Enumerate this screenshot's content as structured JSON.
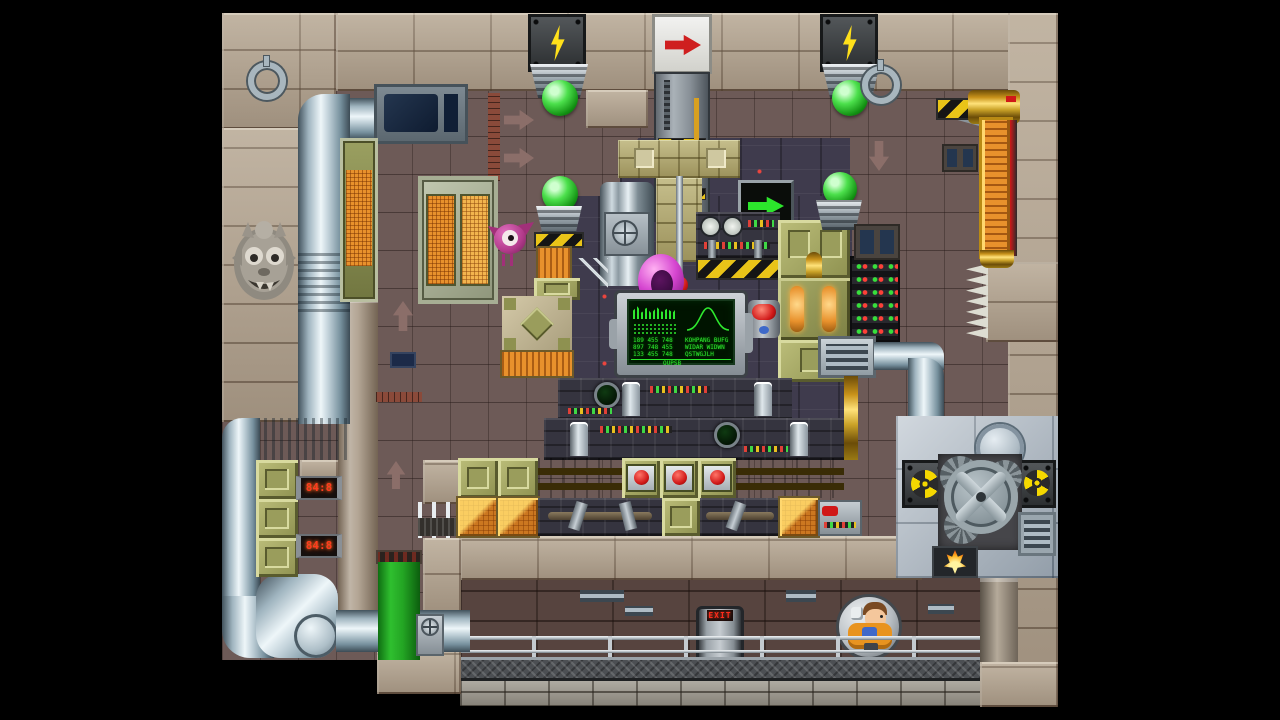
{
  "scene": {
    "name": "industrial factory puzzle level",
    "viewport": "1280x720",
    "letterbox": "black side bars",
    "actors": {
      "player": "engineer inside hamster wheel",
      "enemy": "pink one-eyed flyer"
    },
    "collectibles": {
      "green_gems": 4,
      "pink_ring": 1
    }
  },
  "palette": {
    "interior_wall": "#6d5a57",
    "stone": "#b2a390",
    "chrome_pipe": "#c9d6dd",
    "gold_conveyor": "#e8b21f",
    "olive_crate": "#9da05f",
    "orange_crate": "#e8912c",
    "hazard_yellow": "#e9c418",
    "gem_green": "#2fbf2f",
    "screen_green": "#2ee82e",
    "signal_red": "#cf1f1f",
    "slime_green": "#22a022",
    "machine_dark": "#3f3b4d",
    "room_wall": "#57443f",
    "steel": "#b9c3cd"
  },
  "icons": {
    "lightning": "lightning-bolt",
    "radiation": "radiation-trefoil",
    "arrow": "block-arrow",
    "ring_hook": "wall-ring",
    "gargoyle": "stone-face-carving",
    "gear": "gear-wheel"
  },
  "signs": {
    "lightning_count": 2,
    "radiation_count": 2,
    "red_arrow_direction": "right",
    "green_arrow_direction": "right",
    "wall_arrow_directions": [
      "right",
      "right",
      "up",
      "up",
      "down"
    ]
  },
  "monitor": {
    "numbers": [
      "189 455 748",
      "897 748 455",
      "133 455 748"
    ],
    "words": [
      "KOHPANG BUFG",
      "WIDAR WIDWN",
      "QSTWGJLH"
    ],
    "footer": "QUPSB"
  },
  "leds": [
    {
      "value": "84:8"
    },
    {
      "value": "84:8"
    }
  ],
  "exit": {
    "label": "EXIT"
  }
}
